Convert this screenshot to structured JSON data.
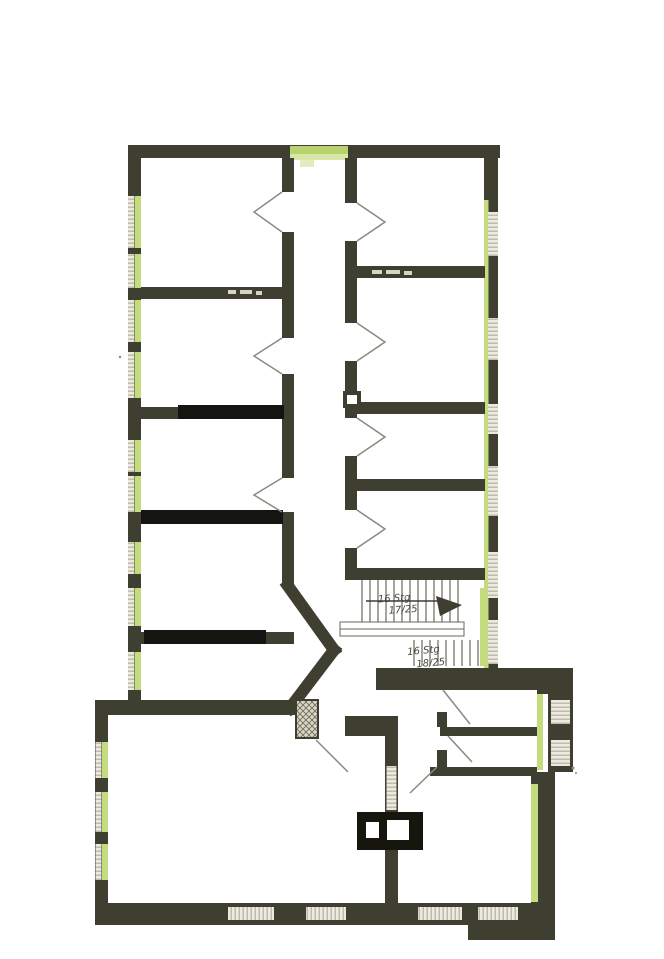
{
  "floor_plan": {
    "stair_annotations": {
      "upper_flight_line1": "16 Stg",
      "upper_flight_line2": "17/25",
      "lower_flight_line1": "16 Stg",
      "lower_flight_line2": "18/25"
    },
    "colors": {
      "wall": "#3e3e31",
      "wall_new_black": "#141410",
      "window_green": "#c4dc7e",
      "window_green_light": "#dce9b0",
      "window_glass": "#eceade",
      "glass_stripe": "#b3b1a4",
      "door_line": "#8a8a80",
      "stair_line": "#6b685a",
      "background": "#ffffff"
    }
  }
}
